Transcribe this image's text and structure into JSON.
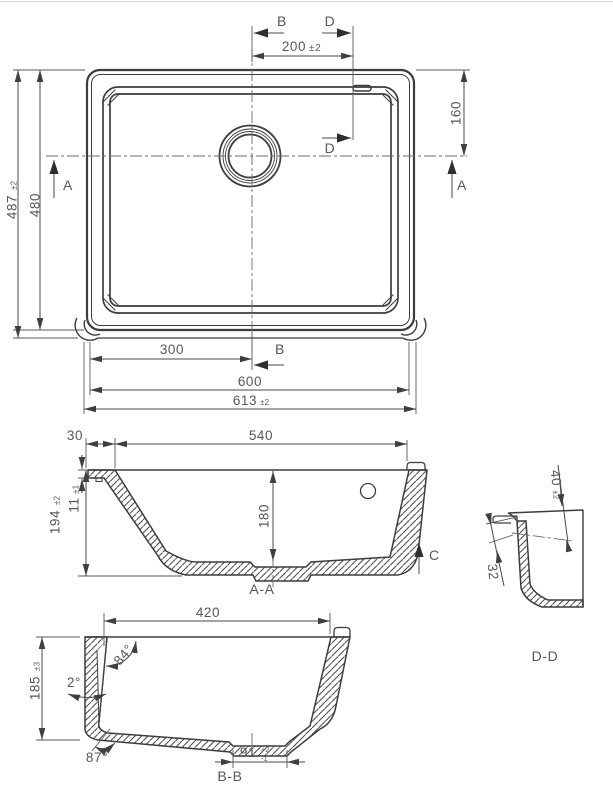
{
  "drawing": {
    "plan": {
      "b_top": "B",
      "d_top": "D",
      "dim_200": "200",
      "dim_200_tol": "±2",
      "dim_160": "160",
      "d_mid": "D",
      "a_left": "A",
      "a_right": "A",
      "dim_487": "487",
      "dim_487_tol": "±2",
      "dim_480": "480",
      "dim_300": "300",
      "b_bottom": "B",
      "dim_600": "600",
      "dim_613": "613",
      "dim_613_tol": "±2"
    },
    "section_aa": {
      "dim_30": "30",
      "dim_540": "540",
      "dim_194": "194",
      "dim_194_tol": "±2",
      "dim_11": "11",
      "dim_11_tol": "±1",
      "dim_180": "180",
      "c_label": "C",
      "title": "A-A"
    },
    "section_dd": {
      "dim_40": "40",
      "dim_40_tol": "±2",
      "dim_32": "32",
      "title": "D-D"
    },
    "section_bb": {
      "dim_420": "420",
      "dim_185": "185",
      "dim_185_tol": "±3",
      "angle_84": "84°",
      "angle_2": "2°",
      "angle_87": "87°",
      "dim_91": "91",
      "dim_91_tol_plus": "+2",
      "dim_91_tol_minus": "-1",
      "title": "B-B"
    }
  }
}
